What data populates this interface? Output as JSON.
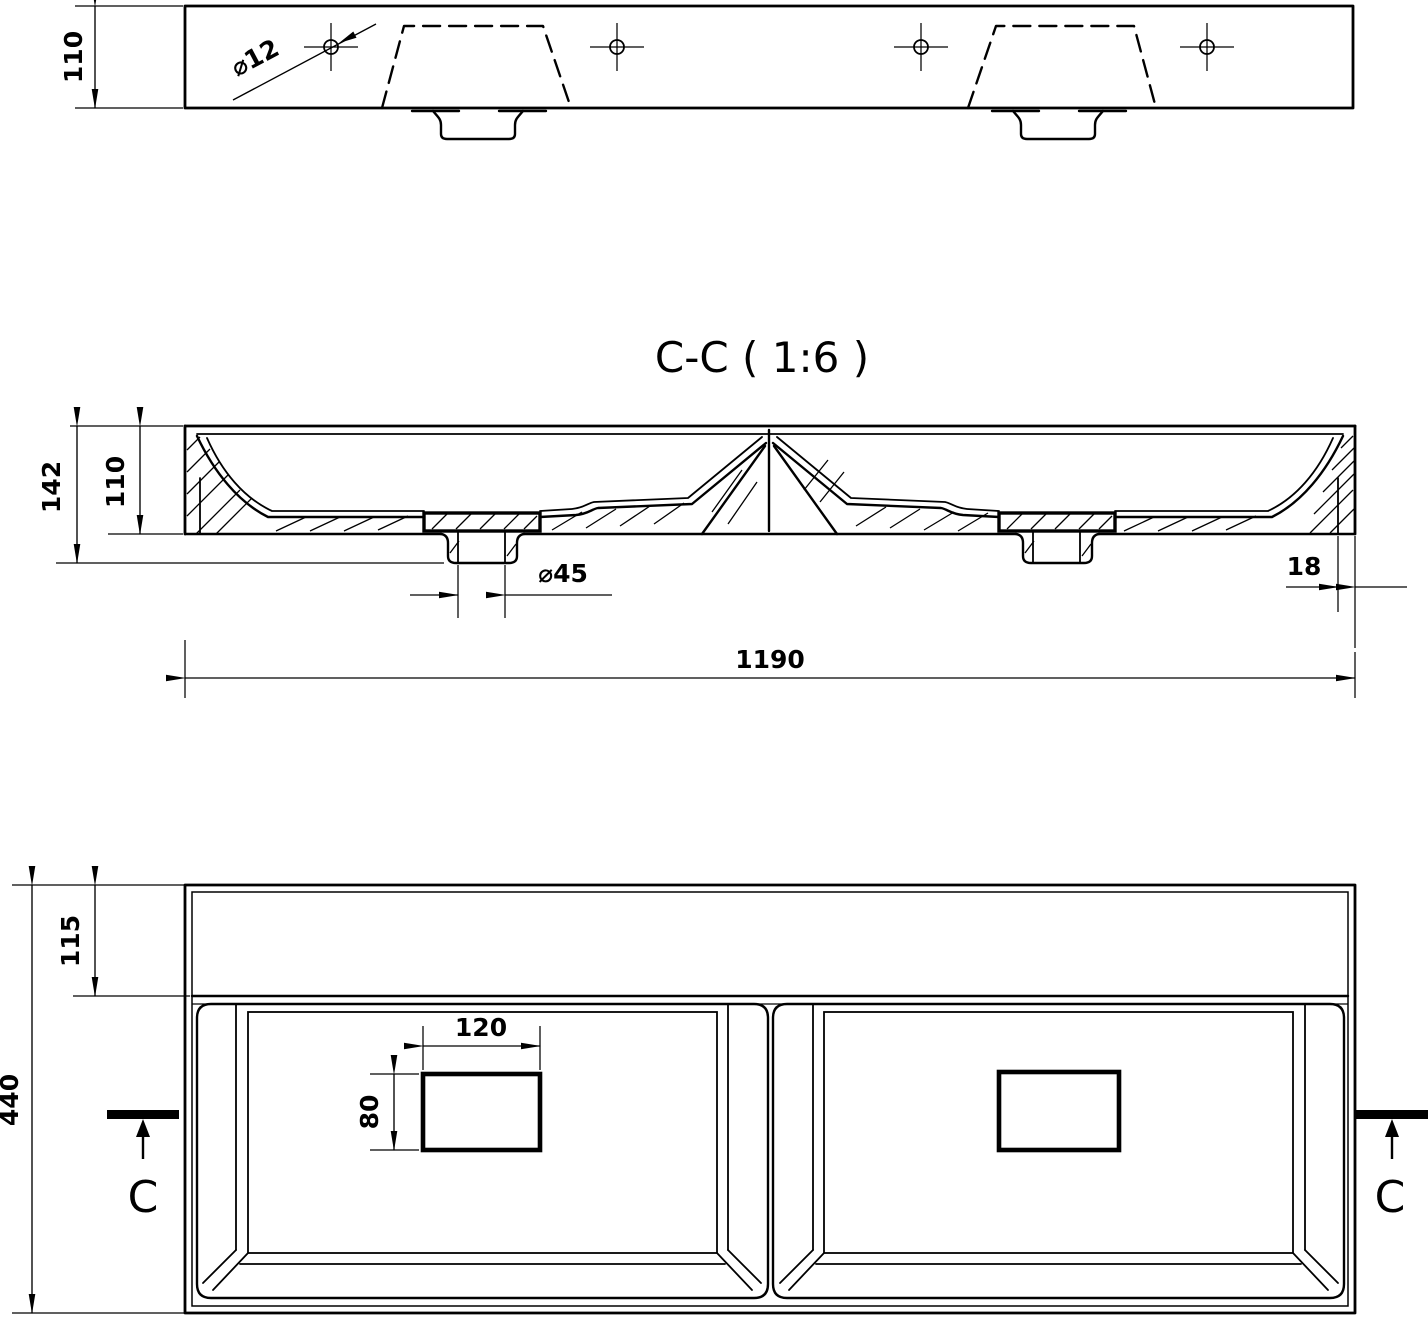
{
  "colors": {
    "ink": "#000000",
    "paper": "#ffffff"
  },
  "section_title": "C-C ( 1:6 )",
  "top_view": {
    "height_dim": "110",
    "mount_hole_dim": "⌀12"
  },
  "section_view": {
    "overall_height_dim": "142",
    "basin_depth_dim": "110",
    "drain_hole_dim": "⌀45",
    "rim_thickness_dim": "18",
    "overall_width_dim": "1190"
  },
  "plan_view": {
    "back_ledge_dim": "115",
    "drain_cutout_width_dim": "120",
    "drain_cutout_depth_dim": "80",
    "overall_depth_dim": "440",
    "cut_label_left": "C",
    "cut_label_right": "C"
  }
}
